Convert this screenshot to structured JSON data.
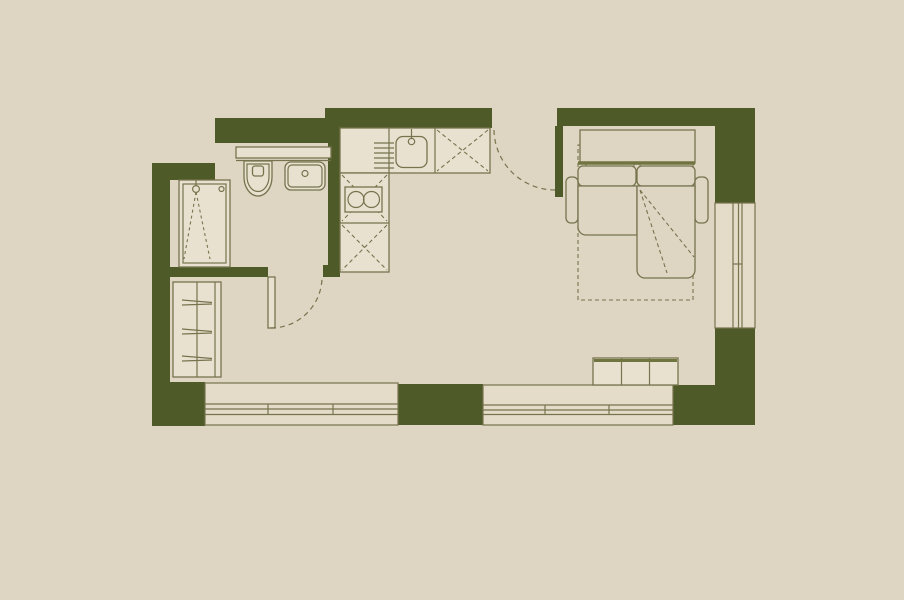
{
  "canvas": {
    "width": 904,
    "height": 600
  },
  "colors": {
    "bg": "#ded6c3",
    "wall": "#4e5a27",
    "line": "#76734e",
    "fixture": "#e8e1cf",
    "window": "#e4dcc9",
    "accent": "#70743f"
  },
  "plan": {
    "type": "studio-apartment-floor-plan",
    "symbols": [
      "shower-icon",
      "toilet-icon",
      "washbasin-icon",
      "vanity-counter-icon",
      "kitchen-sink-icon",
      "faucet-icon",
      "drainer-icon",
      "hob-two-burners-icon",
      "base-cabinet-x-icon",
      "wardrobe-icon",
      "door-swing-icon",
      "sofa-bed-icon",
      "pillows-icon",
      "fold-out-bed-outline-icon",
      "tv-stand-icon",
      "window-icon"
    ]
  }
}
